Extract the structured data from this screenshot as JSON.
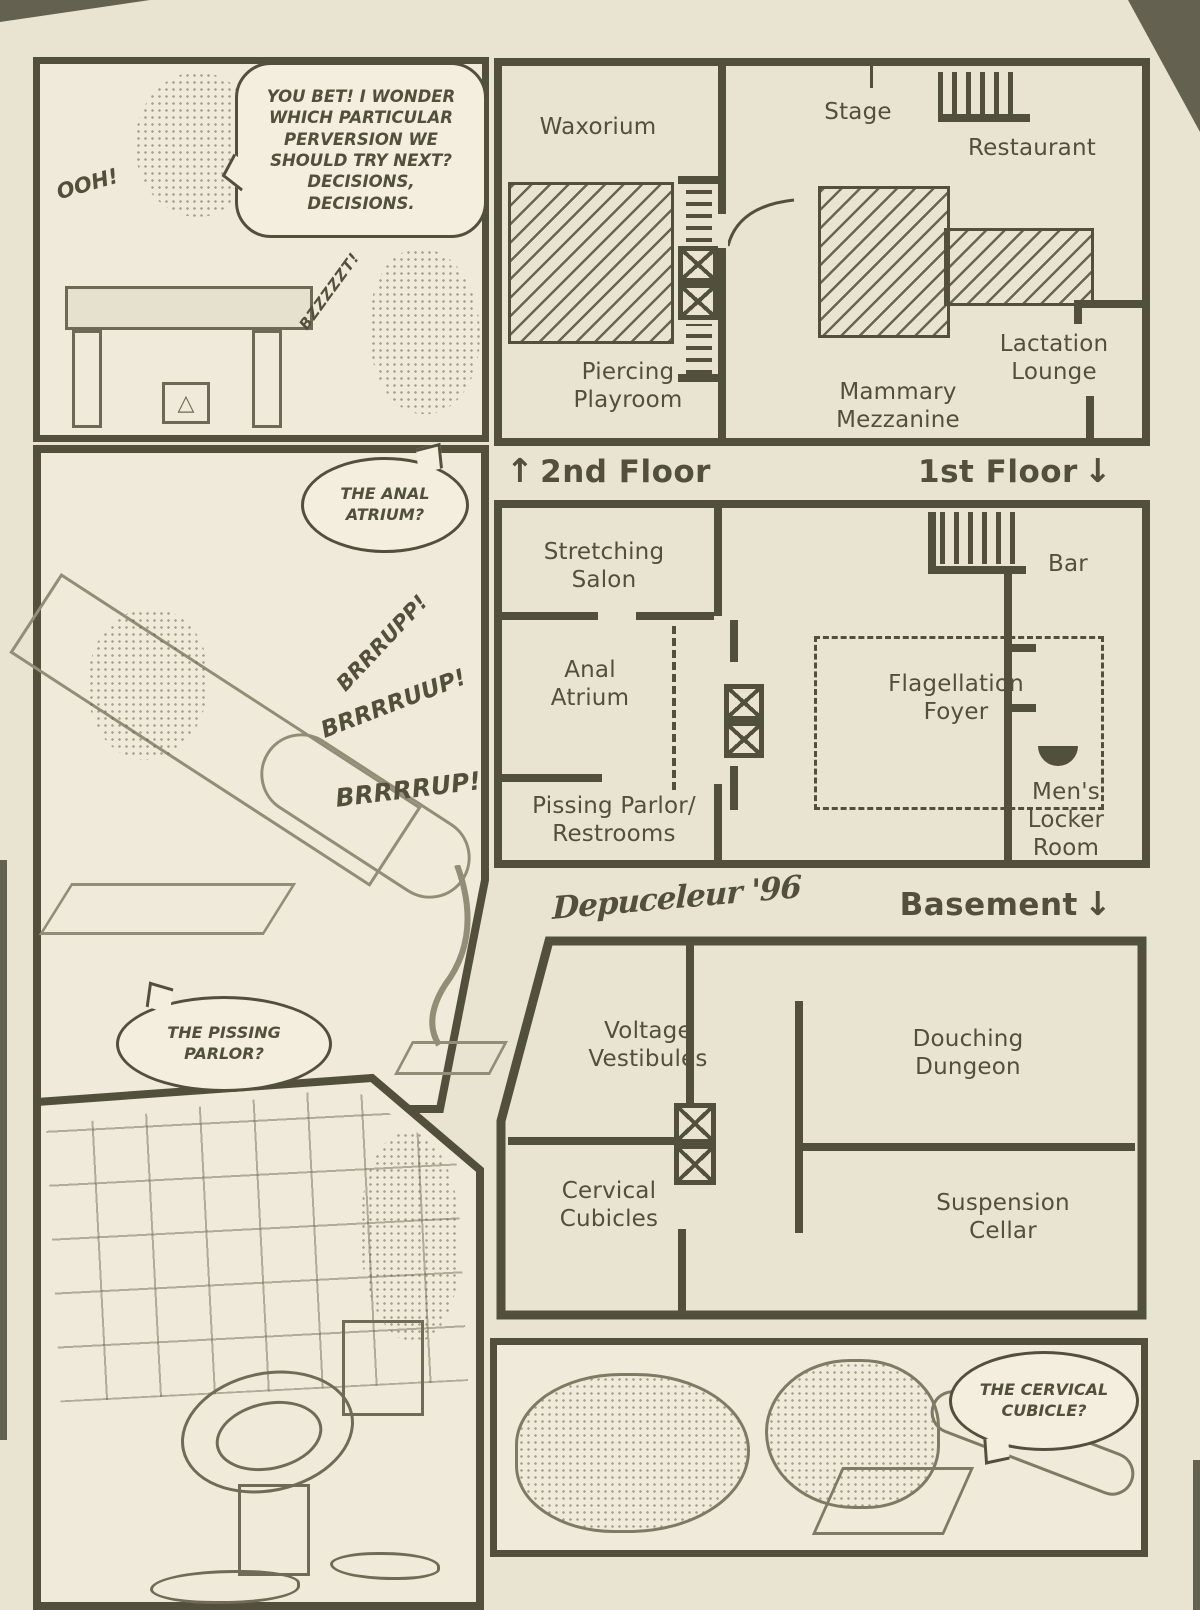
{
  "page": {
    "background_color": "#e9e4d2",
    "panel_background": "#efead9",
    "bubble_background": "#f3eede",
    "ink_color": "#524f3d",
    "art_line_color": "#918d76"
  },
  "panels": {
    "top_left": {
      "speech": "YOU BET! I WONDER WHICH PARTICULAR PERVERSION WE SHOULD TRY NEXT? DECISIONS, DECISIONS.",
      "sfx_ooh": "OOH!",
      "sfx_buzz": "BZZZZZT!",
      "machine_glyph": "△"
    },
    "middle_left": {
      "speech": "THE ANAL ATRIUM?",
      "sfx": [
        "BRRRUPP!",
        "BRRRRUUP!",
        "BRRRRUP!"
      ]
    },
    "bottom_left": {
      "speech": "THE PISSING PARLOR?"
    },
    "bottom_center": {
      "speech": "THE CERVICAL CUBICLE?"
    }
  },
  "floorplan": {
    "second_floor": {
      "label": "2nd Floor",
      "arrow_icon": "↑",
      "rooms": {
        "waxorium": "Waxorium",
        "stage": "Stage",
        "restaurant": "Restaurant",
        "piercing_playroom": "Piercing\nPlayroom",
        "mammary_mezzanine": "Mammary Mezzanine",
        "lactation_lounge": "Lactation\nLounge"
      }
    },
    "first_floor": {
      "label": "1st Floor",
      "arrow_icon": "↓",
      "rooms": {
        "stretching_salon": "Stretching\nSalon",
        "bar": "Bar",
        "anal_atrium": "Anal\nAtrium",
        "flagellation_foyer": "Flagellation\nFoyer",
        "pissing_parlor_restrooms": "Pissing Parlor/\nRestrooms",
        "mens_locker_room": "Men's\nLocker\nRoom"
      }
    },
    "basement": {
      "label": "Basement",
      "arrow_icon": "↓",
      "rooms": {
        "voltage_vestibules": "Voltage\nVestibules",
        "douching_dungeon": "Douching\nDungeon",
        "cervical_cubicles": "Cervical\nCubicles",
        "suspension_cellar": "Suspension\nCellar"
      }
    },
    "signature": "Depuceleur '96"
  }
}
